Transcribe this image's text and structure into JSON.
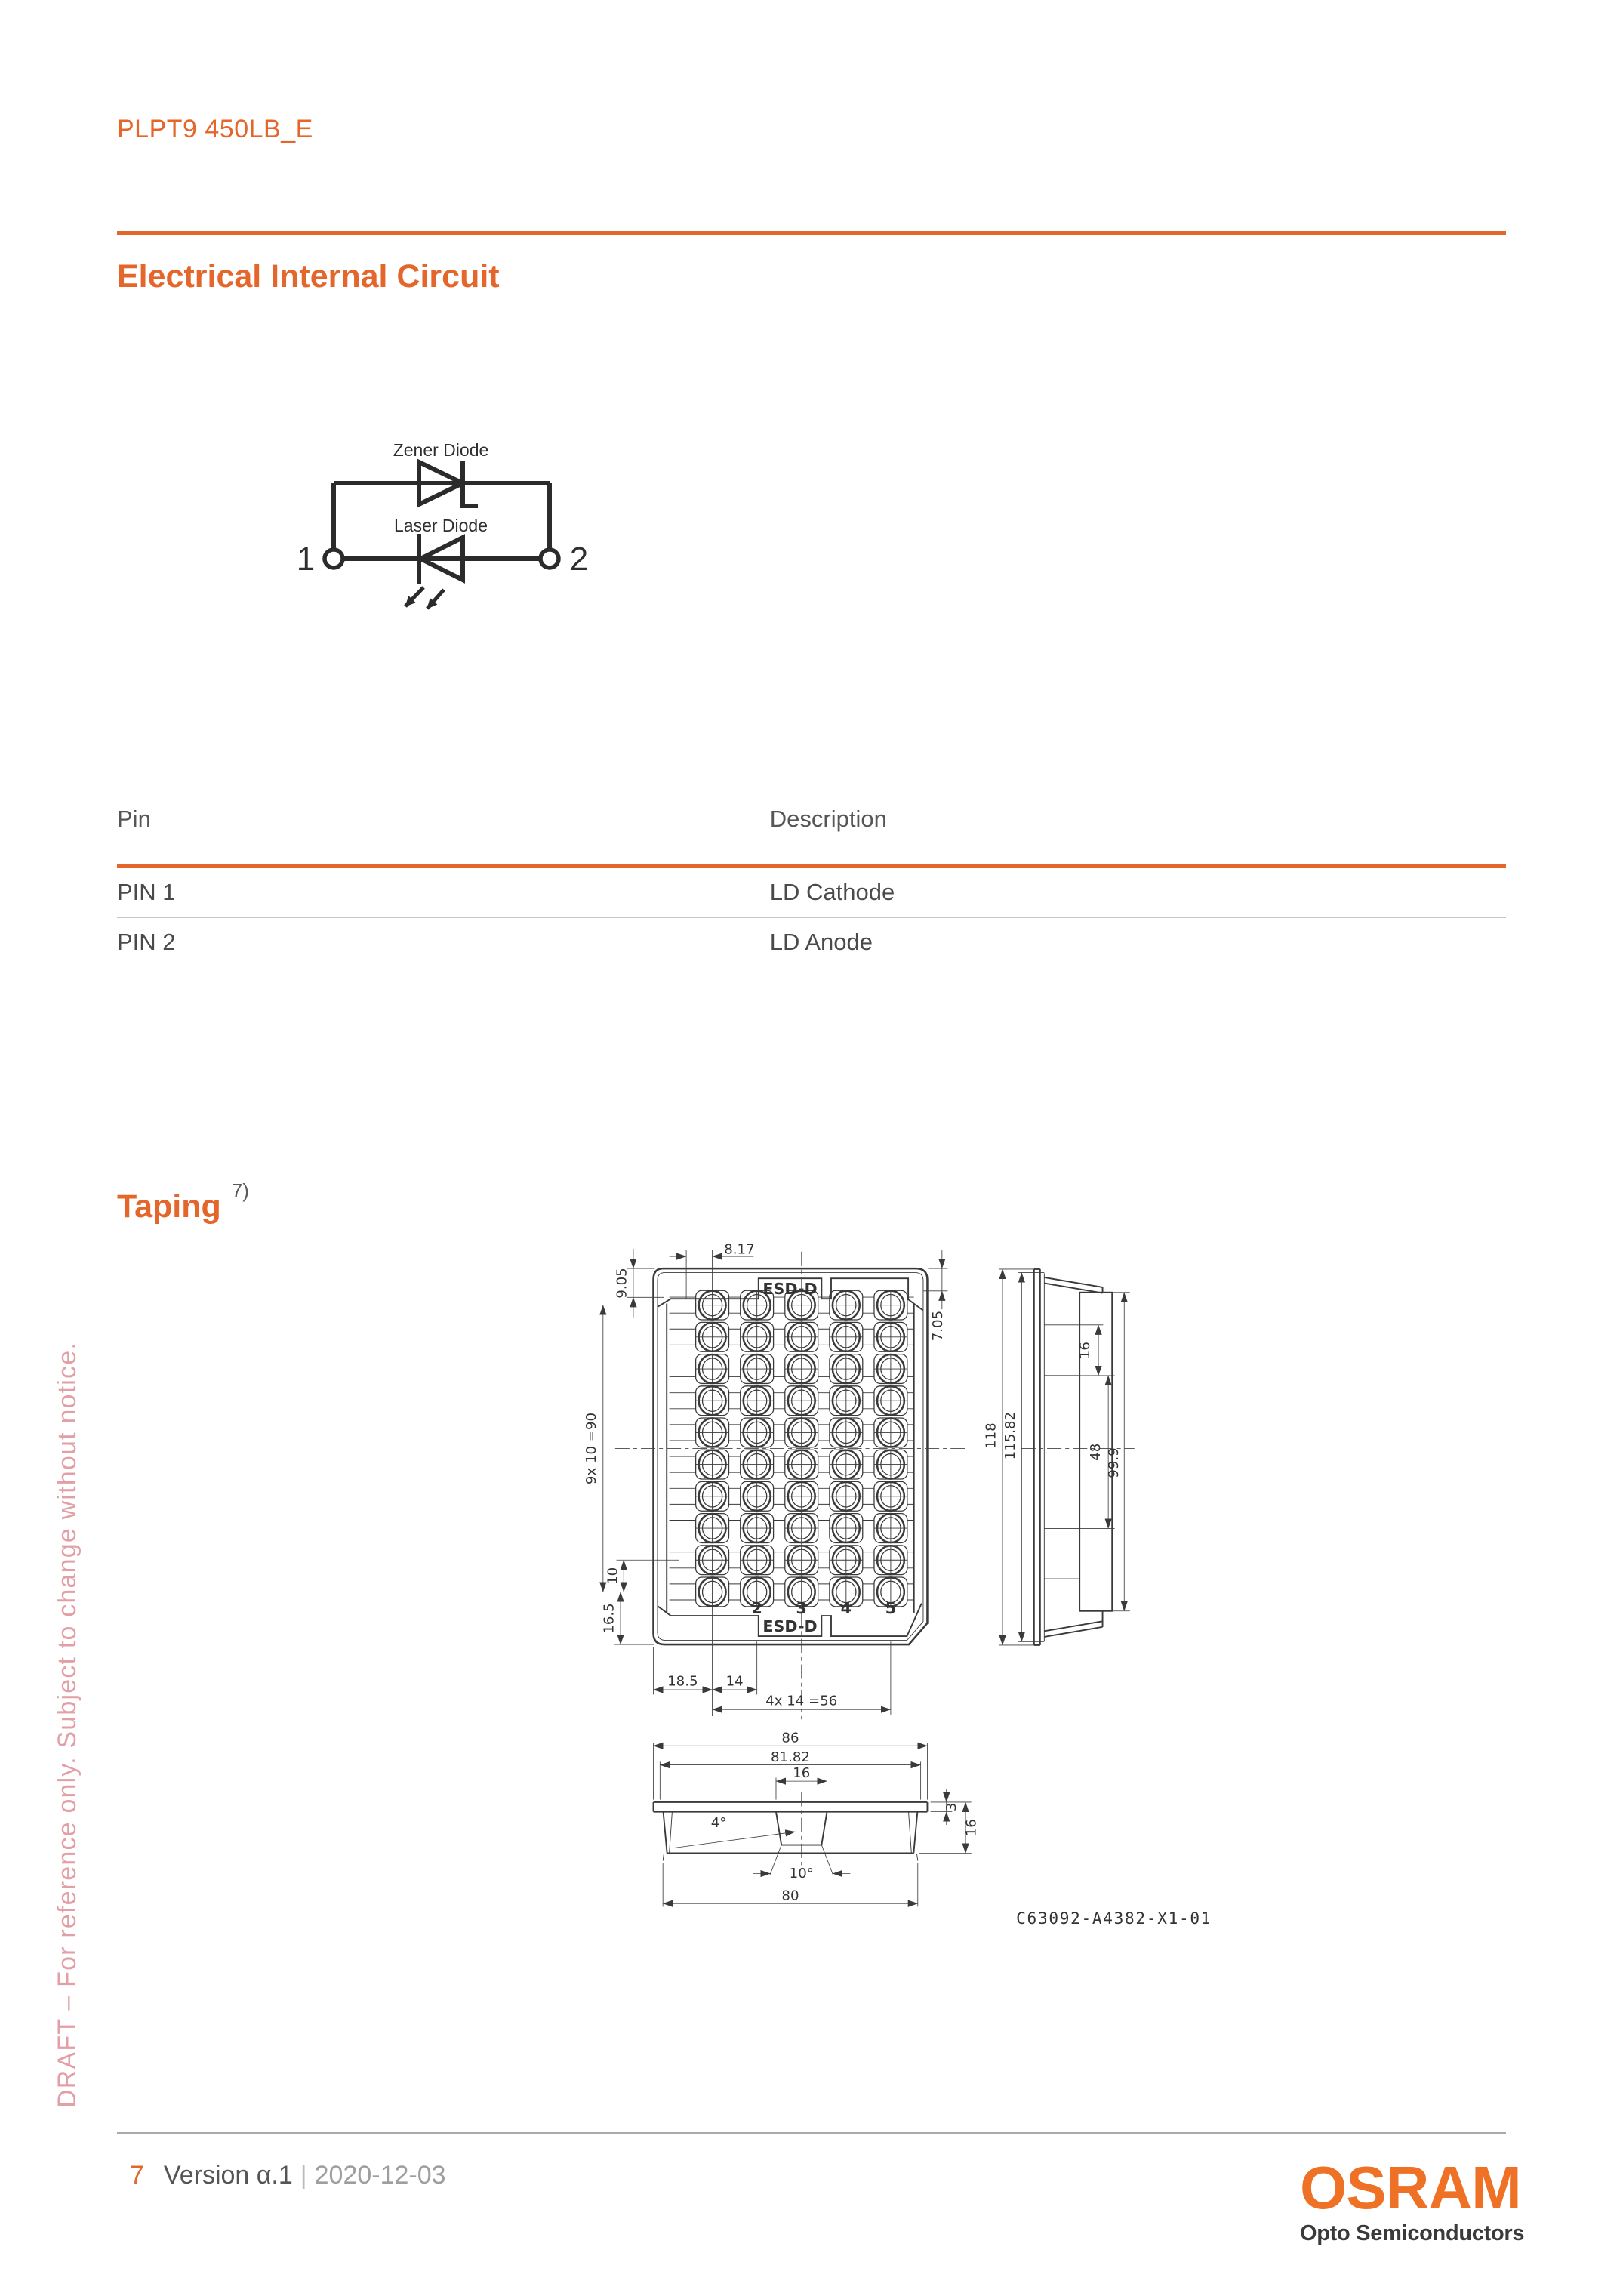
{
  "page": {
    "product_code": "PLPT9 450LB_E",
    "draft_notice": "DRAFT – For reference only. Subject to change without notice.",
    "footer": {
      "page_number": "7",
      "version": "Version α.1",
      "separator": "|",
      "date": "2020-12-03"
    },
    "brand": {
      "logo": "OSRAM",
      "division": "Opto Semiconductors"
    }
  },
  "colors": {
    "accent": "#E4662B",
    "logo_orange": "#EE7125",
    "draft_pink": "#E2A0A6",
    "text_dark": "#4a4a4a",
    "text_light": "#9e9e9e"
  },
  "sections": {
    "circuit": {
      "title": "Electrical Internal Circuit",
      "zener_label": "Zener Diode",
      "laser_label": "Laser Diode",
      "pin1": "1",
      "pin2": "2"
    },
    "pin_table": {
      "col_pin": "Pin",
      "col_description": "Description",
      "rows": [
        {
          "pin": "PIN 1",
          "description": "LD Cathode"
        },
        {
          "pin": "PIN 2",
          "description": "LD Anode"
        }
      ]
    },
    "taping": {
      "title": "Taping",
      "footnote": "7)",
      "esd_top": "ESD-D",
      "esd_bottom": "ESD-D",
      "columns": [
        "2",
        "3",
        "4",
        "5"
      ],
      "dims": {
        "pocket_offset": "8.17",
        "rim_top": "9.05",
        "rim_right": "7.05",
        "rows_total": "9x 10 =90",
        "row_pitch": "10",
        "bottom_margin": "16.5",
        "left_margin": "18.5",
        "col_pitch": "14",
        "cols_total": "4x 14 =56",
        "height": "118",
        "inner_height": "115.82",
        "side_seg_16": "16",
        "side_seg_48": "48",
        "side_flange": "99.9",
        "width": "86",
        "inner_width": "81.82",
        "pocket_width": "16",
        "wall_angle": "4°",
        "pocket_angle": "10°",
        "bottom_width": "80",
        "flange_thickness": "3",
        "total_height": "16"
      },
      "drawing_number": "C63092-A4382-X1-01"
    }
  }
}
